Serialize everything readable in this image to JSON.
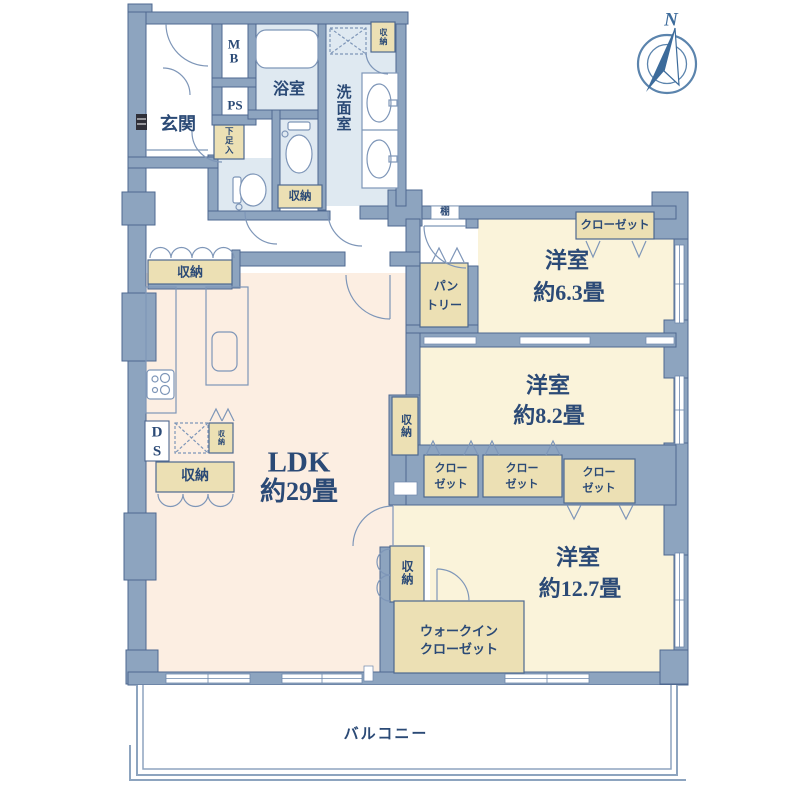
{
  "compass": {
    "north_label": "N"
  },
  "rooms": {
    "ldk": {
      "name": "LDK",
      "size": "約29畳"
    },
    "bedroom_63": {
      "name": "洋室",
      "size": "約6.3畳"
    },
    "bedroom_82": {
      "name": "洋室",
      "size": "約8.2畳"
    },
    "bedroom_127": {
      "name": "洋室",
      "size": "約12.7畳"
    },
    "genkan": {
      "name": "玄関"
    },
    "bath": {
      "name": "浴室"
    },
    "washroom": {
      "name": "洗面室"
    },
    "balcony": {
      "name": "バルコニー"
    }
  },
  "labels": {
    "storage": "収納",
    "closet": "クローゼット",
    "closet_line1": "クロー",
    "closet_line2": "ゼット",
    "wic_line1": "ウォークイン",
    "wic_line2": "クローゼット",
    "pantry_line1": "パン",
    "pantry_line2": "トリー",
    "shoe_cabinet": "下足入",
    "shelf": "棚",
    "mb_line1": "M",
    "mb_line2": "B",
    "ps": "PS",
    "ds_line1": "D",
    "ds_line2": "S"
  },
  "colors": {
    "wall": "#8da4bf",
    "wall_line": "#4e6890",
    "ldk_floor": "#fceee2",
    "bedroom_floor": "#faf3da",
    "wet_floor": "#dfe9f1",
    "storage_fill": "#ece0b4",
    "text": "#2b4a76",
    "compass": "#3c6b9b"
  }
}
